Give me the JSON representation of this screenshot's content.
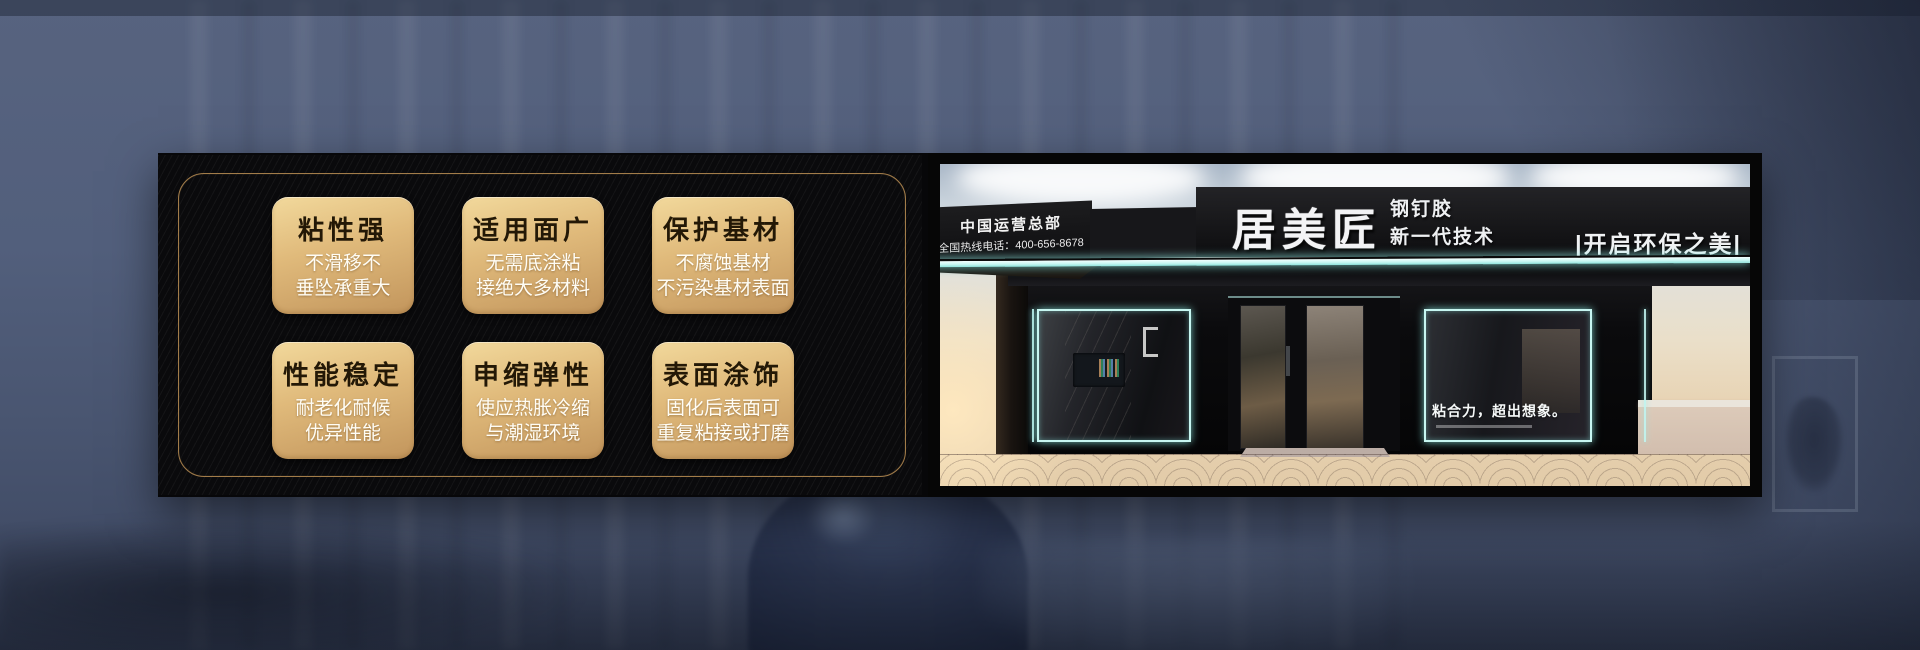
{
  "features": {
    "cards": [
      {
        "title": "粘性强",
        "line1": "不滑移不",
        "line2": "垂坠承重大"
      },
      {
        "title": "适用面广",
        "line1": "无需底涂粘",
        "line2": "接绝大多材料"
      },
      {
        "title": "保护基材",
        "line1": "不腐蚀基材",
        "line2": "不污染基材表面"
      },
      {
        "title": "性能稳定",
        "line1": "耐老化耐候",
        "line2": "优异性能"
      },
      {
        "title": "申缩弹性",
        "line1": "使应热胀冷缩",
        "line2": "与潮湿环境"
      },
      {
        "title": "表面涂饰",
        "line1": "固化后表面可",
        "line2": "重复粘接或打磨"
      }
    ]
  },
  "storefront": {
    "hq_label": "中国运营总部",
    "hotline": "全国热线电话：400-656-8678",
    "brand": "居美匠",
    "product": "钢钉胶",
    "tech": "新一代技术",
    "slogan_right": "|开启环保之美|",
    "window_slogan": "粘合力，超出想象。"
  },
  "colors": {
    "background_blue": "#52607c",
    "panel_black": "#0a0a0c",
    "gold_border": "#b28850",
    "card_gold_top": "#f2d99c",
    "card_gold_bottom": "#c2955c",
    "neon_cyan": "#c8f7f2",
    "sign_text": "#f3f3f5"
  }
}
